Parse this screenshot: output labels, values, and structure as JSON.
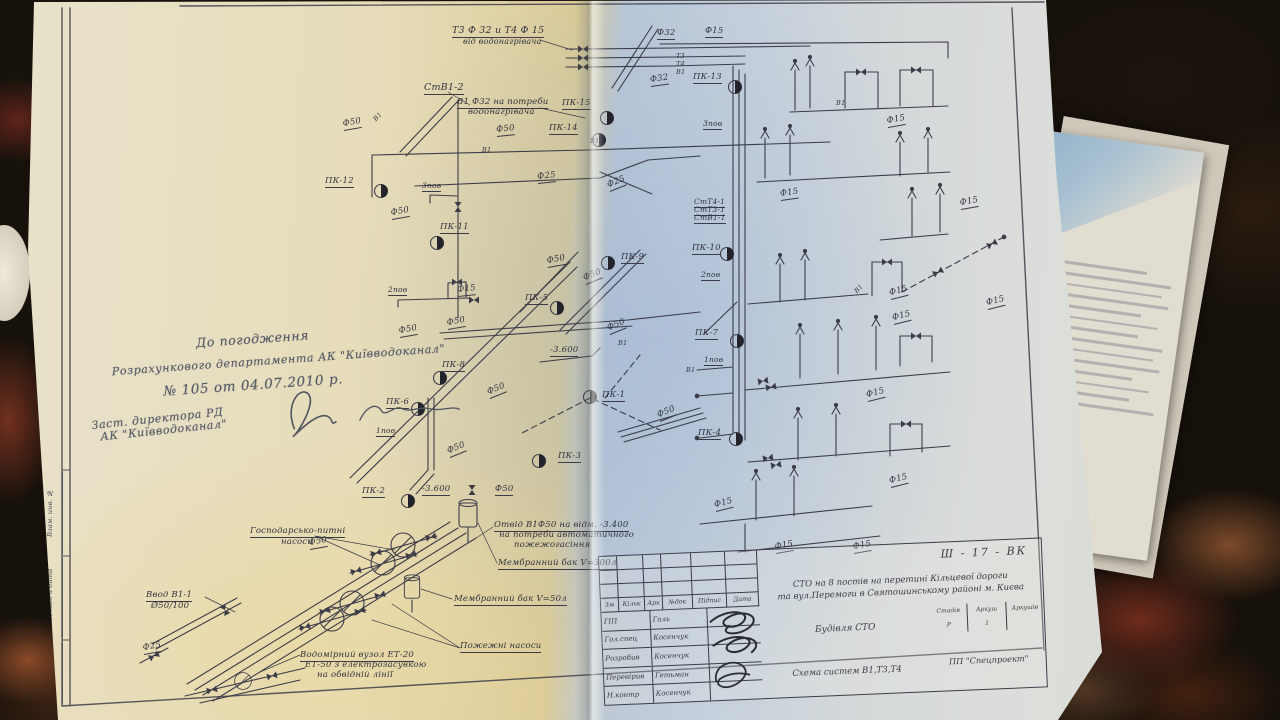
{
  "drawing": {
    "approval_note": {
      "line1": "До погодження",
      "line2": "Розрахункового департамента АК \"Київводоканал\"",
      "line3": "№ 105   от 04.07.2010 р.",
      "line4": "Заст. директора РД",
      "line5": "АК \"Київводоканал\""
    },
    "margin_stamps": [
      "Взам. инв. №",
      "Подпись и дата",
      "Инв. № подл."
    ],
    "ink_color": "#3c3c49",
    "title_block": {
      "code": "Ш - 17 - ВК",
      "project_line1": "СТО на 8 постів на перетині Кільцевої дороги",
      "project_line2": "та вул.Перемоги в Святошинському районі м. Києва",
      "object_name": "Будівля СТО",
      "drawing_name": "Схема систем В1,Т3,Т4",
      "company": "ПП \"Спецпроект\"",
      "stage_label": "Стадія",
      "sheet_label": "Аркуш",
      "sheets_label": "Аркушів",
      "stage": "Р",
      "sheet": "1",
      "cols": [
        "Зм",
        "Кільк",
        "Арк",
        "№док",
        "Підпис",
        "Дата"
      ],
      "sign_rows": [
        {
          "role": "ГІП",
          "name": "Голь"
        },
        {
          "role": "Гол.спец",
          "name": "Косенчук"
        },
        {
          "role": "Розробив",
          "name": "Косенчук"
        },
        {
          "role": "Перевірив",
          "name": "Гетьман"
        },
        {
          "role": "Н.контр",
          "name": "Косенчук"
        }
      ]
    },
    "diagram": {
      "labels": [
        {
          "t": "Т3 Ф 32 и Т4 Ф 15",
          "x": 452,
          "y": 26,
          "u": 1,
          "fs": 9.5
        },
        {
          "t": "від водонагрівача",
          "x": 463,
          "y": 38,
          "fs": 8
        },
        {
          "t": "Ф32",
          "x": 657,
          "y": 29,
          "u": 1
        },
        {
          "t": "Ф15",
          "x": 705,
          "y": 27,
          "u": 1
        },
        {
          "t": "Т3",
          "x": 676,
          "y": 53,
          "fs": 6.5
        },
        {
          "t": "Т4",
          "x": 676,
          "y": 61,
          "fs": 6.5
        },
        {
          "t": "В1",
          "x": 676,
          "y": 69,
          "fs": 6.5
        },
        {
          "t": "Ф32",
          "x": 651,
          "y": 76,
          "u": 1,
          "r": -8
        },
        {
          "t": "ПК-13",
          "x": 693,
          "y": 73,
          "u": 1
        },
        {
          "t": "СтВ1-2",
          "x": 424,
          "y": 83,
          "u": 1,
          "fs": 9.5
        },
        {
          "t": "В1 Ф32 на потреби",
          "x": 457,
          "y": 98,
          "u": 1
        },
        {
          "t": "водонагрівача",
          "x": 468,
          "y": 108
        },
        {
          "t": "ПК-15",
          "x": 562,
          "y": 99,
          "u": 1
        },
        {
          "t": "ПК-14",
          "x": 549,
          "y": 124,
          "u": 1
        },
        {
          "t": "Ф50",
          "x": 344,
          "y": 120,
          "u": 1,
          "r": -10
        },
        {
          "t": "В1",
          "x": 377,
          "y": 116,
          "r": -46,
          "fs": 6.5
        },
        {
          "t": "Ф50",
          "x": 497,
          "y": 126,
          "u": 1,
          "r": -6
        },
        {
          "t": "В1",
          "x": 590,
          "y": 138,
          "fs": 6.5
        },
        {
          "t": "3пов",
          "x": 703,
          "y": 120,
          "u": 1,
          "fs": 7.5
        },
        {
          "t": "В1",
          "x": 482,
          "y": 147,
          "fs": 6.5
        },
        {
          "t": "Ф15",
          "x": 781,
          "y": 190,
          "u": 1,
          "r": -8
        },
        {
          "t": "ПК-12",
          "x": 325,
          "y": 177,
          "u": 1
        },
        {
          "t": "3пов",
          "x": 422,
          "y": 182,
          "u": 1,
          "fs": 7.5
        },
        {
          "t": "Ф25",
          "x": 538,
          "y": 173,
          "u": 1,
          "r": -6
        },
        {
          "t": "Ф25",
          "x": 610,
          "y": 181,
          "u": 1,
          "r": -22
        },
        {
          "t": "Ф50",
          "x": 392,
          "y": 209,
          "u": 1,
          "r": -10
        },
        {
          "t": "ПК-11",
          "x": 440,
          "y": 223,
          "u": 1
        },
        {
          "t": "СтТ4-1",
          "x": 694,
          "y": 198,
          "u": 1,
          "fs": 7.5
        },
        {
          "t": "СтТ3-1",
          "x": 694,
          "y": 206,
          "u": 1,
          "fs": 7.5
        },
        {
          "t": "СтВ1-1",
          "x": 694,
          "y": 214,
          "u": 1,
          "fs": 7.5
        },
        {
          "t": "ПК-10",
          "x": 692,
          "y": 244,
          "u": 1
        },
        {
          "t": "ПК-9",
          "x": 621,
          "y": 253,
          "u": 1
        },
        {
          "t": "Ф50",
          "x": 548,
          "y": 257,
          "u": 1,
          "r": -10
        },
        {
          "t": "Ф50",
          "x": 586,
          "y": 274,
          "u": 1,
          "r": -22
        },
        {
          "t": "2пов",
          "x": 701,
          "y": 271,
          "u": 1,
          "fs": 7.5
        },
        {
          "t": "2пов",
          "x": 388,
          "y": 286,
          "u": 1,
          "fs": 7.5
        },
        {
          "t": "Ф15",
          "x": 458,
          "y": 286,
          "u": 1,
          "r": -6
        },
        {
          "t": "ПК-5",
          "x": 525,
          "y": 294,
          "u": 1
        },
        {
          "t": "В1",
          "x": 858,
          "y": 288,
          "r": -46,
          "fs": 6.5
        },
        {
          "t": "Ф15",
          "x": 891,
          "y": 289,
          "u": 1,
          "r": -14
        },
        {
          "t": "Ф15",
          "x": 894,
          "y": 314,
          "u": 1,
          "r": -14
        },
        {
          "t": "Ф15",
          "x": 988,
          "y": 299,
          "u": 1,
          "r": -14
        },
        {
          "t": "Ф50",
          "x": 448,
          "y": 319,
          "u": 1,
          "r": -10
        },
        {
          "t": "Ф50",
          "x": 400,
          "y": 327,
          "u": 1,
          "r": -10
        },
        {
          "t": "ПК-7",
          "x": 695,
          "y": 329,
          "u": 1
        },
        {
          "t": "Ф50",
          "x": 610,
          "y": 324,
          "u": 1,
          "r": -22
        },
        {
          "t": "-3.600",
          "x": 550,
          "y": 346,
          "u": 1
        },
        {
          "t": "В1",
          "x": 618,
          "y": 340,
          "fs": 6.5
        },
        {
          "t": "ПК-8",
          "x": 442,
          "y": 361,
          "u": 1
        },
        {
          "t": "1пов",
          "x": 704,
          "y": 356,
          "u": 1,
          "fs": 7.5
        },
        {
          "t": "В1",
          "x": 686,
          "y": 367,
          "fs": 6.5
        },
        {
          "t": "ПК-1",
          "x": 602,
          "y": 391,
          "u": 1
        },
        {
          "t": "Ф50",
          "x": 660,
          "y": 411,
          "u": 1,
          "r": -22
        },
        {
          "t": "ПК-6",
          "x": 386,
          "y": 398,
          "u": 1
        },
        {
          "t": "Ф50",
          "x": 490,
          "y": 388,
          "u": 1,
          "r": -22
        },
        {
          "t": "1пов",
          "x": 376,
          "y": 427,
          "u": 1,
          "fs": 7.5
        },
        {
          "t": "ПК-3",
          "x": 558,
          "y": 452,
          "u": 1
        },
        {
          "t": "Ф50",
          "x": 450,
          "y": 447,
          "u": 1,
          "r": -22
        },
        {
          "t": "ПК-4",
          "x": 698,
          "y": 429,
          "u": 1
        },
        {
          "t": "Ф15",
          "x": 868,
          "y": 391,
          "u": 1,
          "r": -14
        },
        {
          "t": "Ф15",
          "x": 891,
          "y": 477,
          "u": 1,
          "r": -14
        },
        {
          "t": "ПК-2",
          "x": 362,
          "y": 487,
          "u": 1
        },
        {
          "t": "-3.600",
          "x": 422,
          "y": 485,
          "u": 1
        },
        {
          "t": "Ф50",
          "x": 495,
          "y": 485,
          "u": 1
        },
        {
          "t": "Ф15",
          "x": 716,
          "y": 501,
          "u": 1,
          "r": -14
        },
        {
          "t": "Ф15",
          "x": 776,
          "y": 543,
          "u": 1,
          "r": -10
        },
        {
          "t": "Ф15",
          "x": 854,
          "y": 543,
          "u": 1,
          "r": -10
        },
        {
          "t": "Господарсько-питні",
          "x": 250,
          "y": 527,
          "u": 1
        },
        {
          "t": "насоси",
          "x": 281,
          "y": 538
        },
        {
          "t": "Отвід В1Ф50 на відм. -3.400",
          "x": 494,
          "y": 521,
          "u": 1
        },
        {
          "t": "на потреби автоматичного",
          "x": 499,
          "y": 531
        },
        {
          "t": "пожежогасіння",
          "x": 514,
          "y": 541
        },
        {
          "t": "Ф50",
          "x": 310,
          "y": 539,
          "u": 1,
          "r": -10
        },
        {
          "t": "Мембранний бак V=300л",
          "x": 498,
          "y": 559,
          "u": 1
        },
        {
          "t": "Мембранний бак V=50л",
          "x": 454,
          "y": 595,
          "u": 1
        },
        {
          "t": "Ввод В1-1",
          "x": 146,
          "y": 591,
          "u": 1
        },
        {
          "t": "Ø50/100",
          "x": 151,
          "y": 602
        },
        {
          "t": "Ф25",
          "x": 144,
          "y": 644,
          "u": 1,
          "r": -10
        },
        {
          "t": "Водомірний вузол ЕТ-20",
          "x": 300,
          "y": 651,
          "u": 1
        },
        {
          "t": "ЕТ-50 з електрозасувкою",
          "x": 305,
          "y": 661
        },
        {
          "t": "на обвідній лінії",
          "x": 317,
          "y": 671
        },
        {
          "t": "Пожежні насоси",
          "x": 460,
          "y": 642,
          "u": 1
        },
        {
          "t": "В1",
          "x": 836,
          "y": 100,
          "fs": 6.5
        },
        {
          "t": "Ф15",
          "x": 888,
          "y": 117,
          "u": 1,
          "r": -10
        },
        {
          "t": "Ф15",
          "x": 961,
          "y": 199,
          "u": 1,
          "r": -10
        }
      ]
    }
  }
}
